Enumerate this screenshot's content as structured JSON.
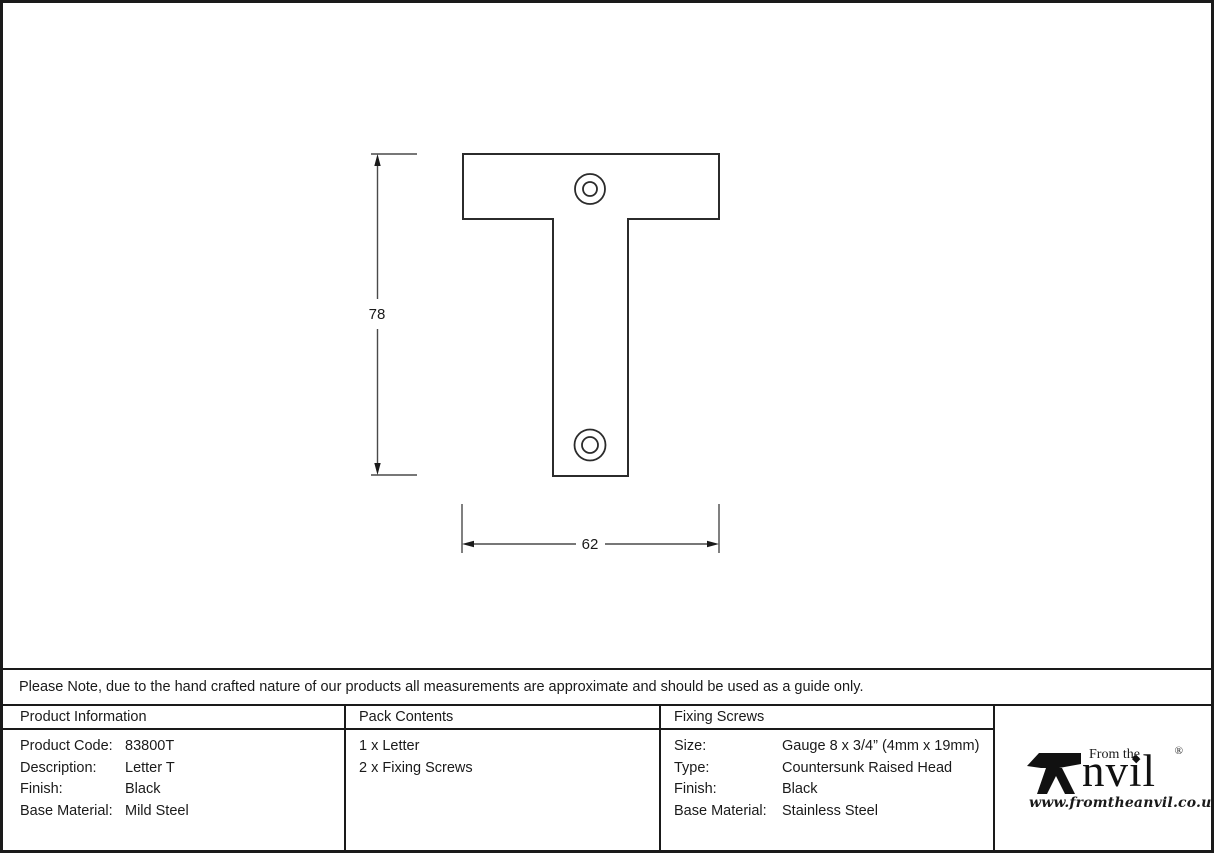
{
  "drawing": {
    "height_label": "78",
    "width_label": "62"
  },
  "note": "Please Note, due to the hand crafted nature of our products all measurements are approximate and should be used as a guide only.",
  "table": {
    "product_information": {
      "header": "Product Information",
      "rows": [
        {
          "label": "Product Code:",
          "value": "83800T"
        },
        {
          "label": "Description:",
          "value": "Letter T"
        },
        {
          "label": "Finish:",
          "value": "Black"
        },
        {
          "label": "Base Material:",
          "value": "Mild Steel"
        }
      ]
    },
    "pack_contents": {
      "header": "Pack Contents",
      "items": [
        "1 x Letter",
        "2 x Fixing Screws"
      ]
    },
    "fixing_screws": {
      "header": "Fixing Screws",
      "rows": [
        {
          "label": "Size:",
          "value": "Gauge 8 x 3/4” (4mm x 19mm)"
        },
        {
          "label": "Type:",
          "value": "Countersunk Raised Head"
        },
        {
          "label": "Finish:",
          "value": "Black"
        },
        {
          "label": "Base Material:",
          "value": "Stainless Steel"
        }
      ]
    }
  },
  "logo": {
    "tagline": "From the",
    "brand": "Anvil",
    "brand_tail": "nvil",
    "registered": "®",
    "diamond_icon": "◆",
    "website": "www.fromtheanvil.co.uk"
  }
}
